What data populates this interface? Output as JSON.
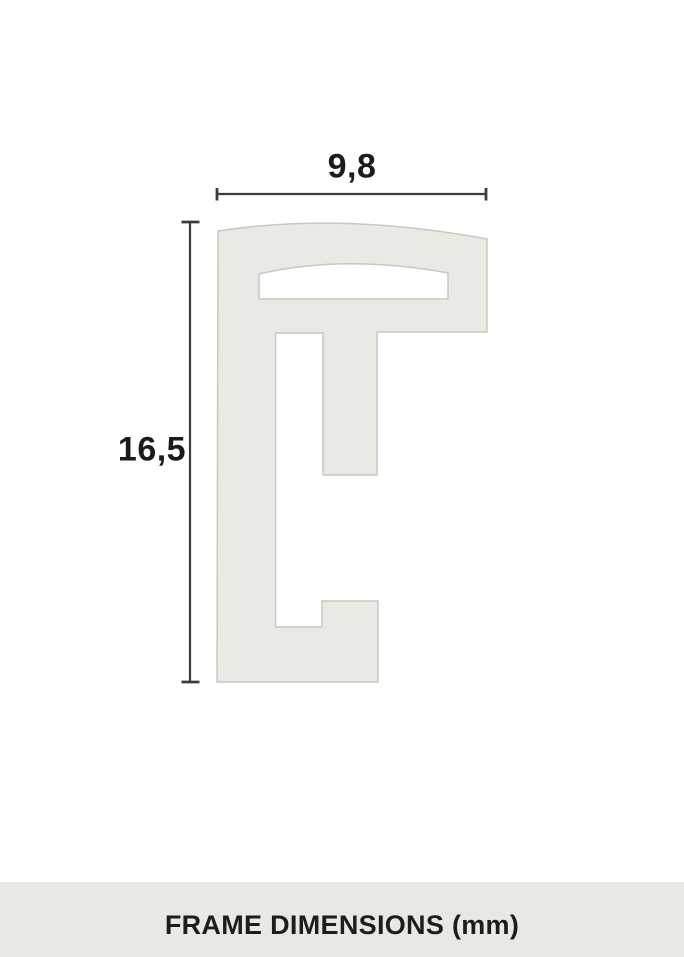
{
  "diagram": {
    "width_label": "9,8",
    "height_label": "16,5"
  },
  "footer": {
    "title": "FRAME DIMENSIONS (mm)"
  },
  "colors": {
    "background": "#ffffff",
    "profile_fill": "#e8eae4",
    "profile_stroke": "#c6c8c2",
    "dimension_line": "#3c3c3c",
    "label_text": "#1b1b1b",
    "footer_bg": "#e9e9e4",
    "footer_text": "#1d1d1d"
  }
}
